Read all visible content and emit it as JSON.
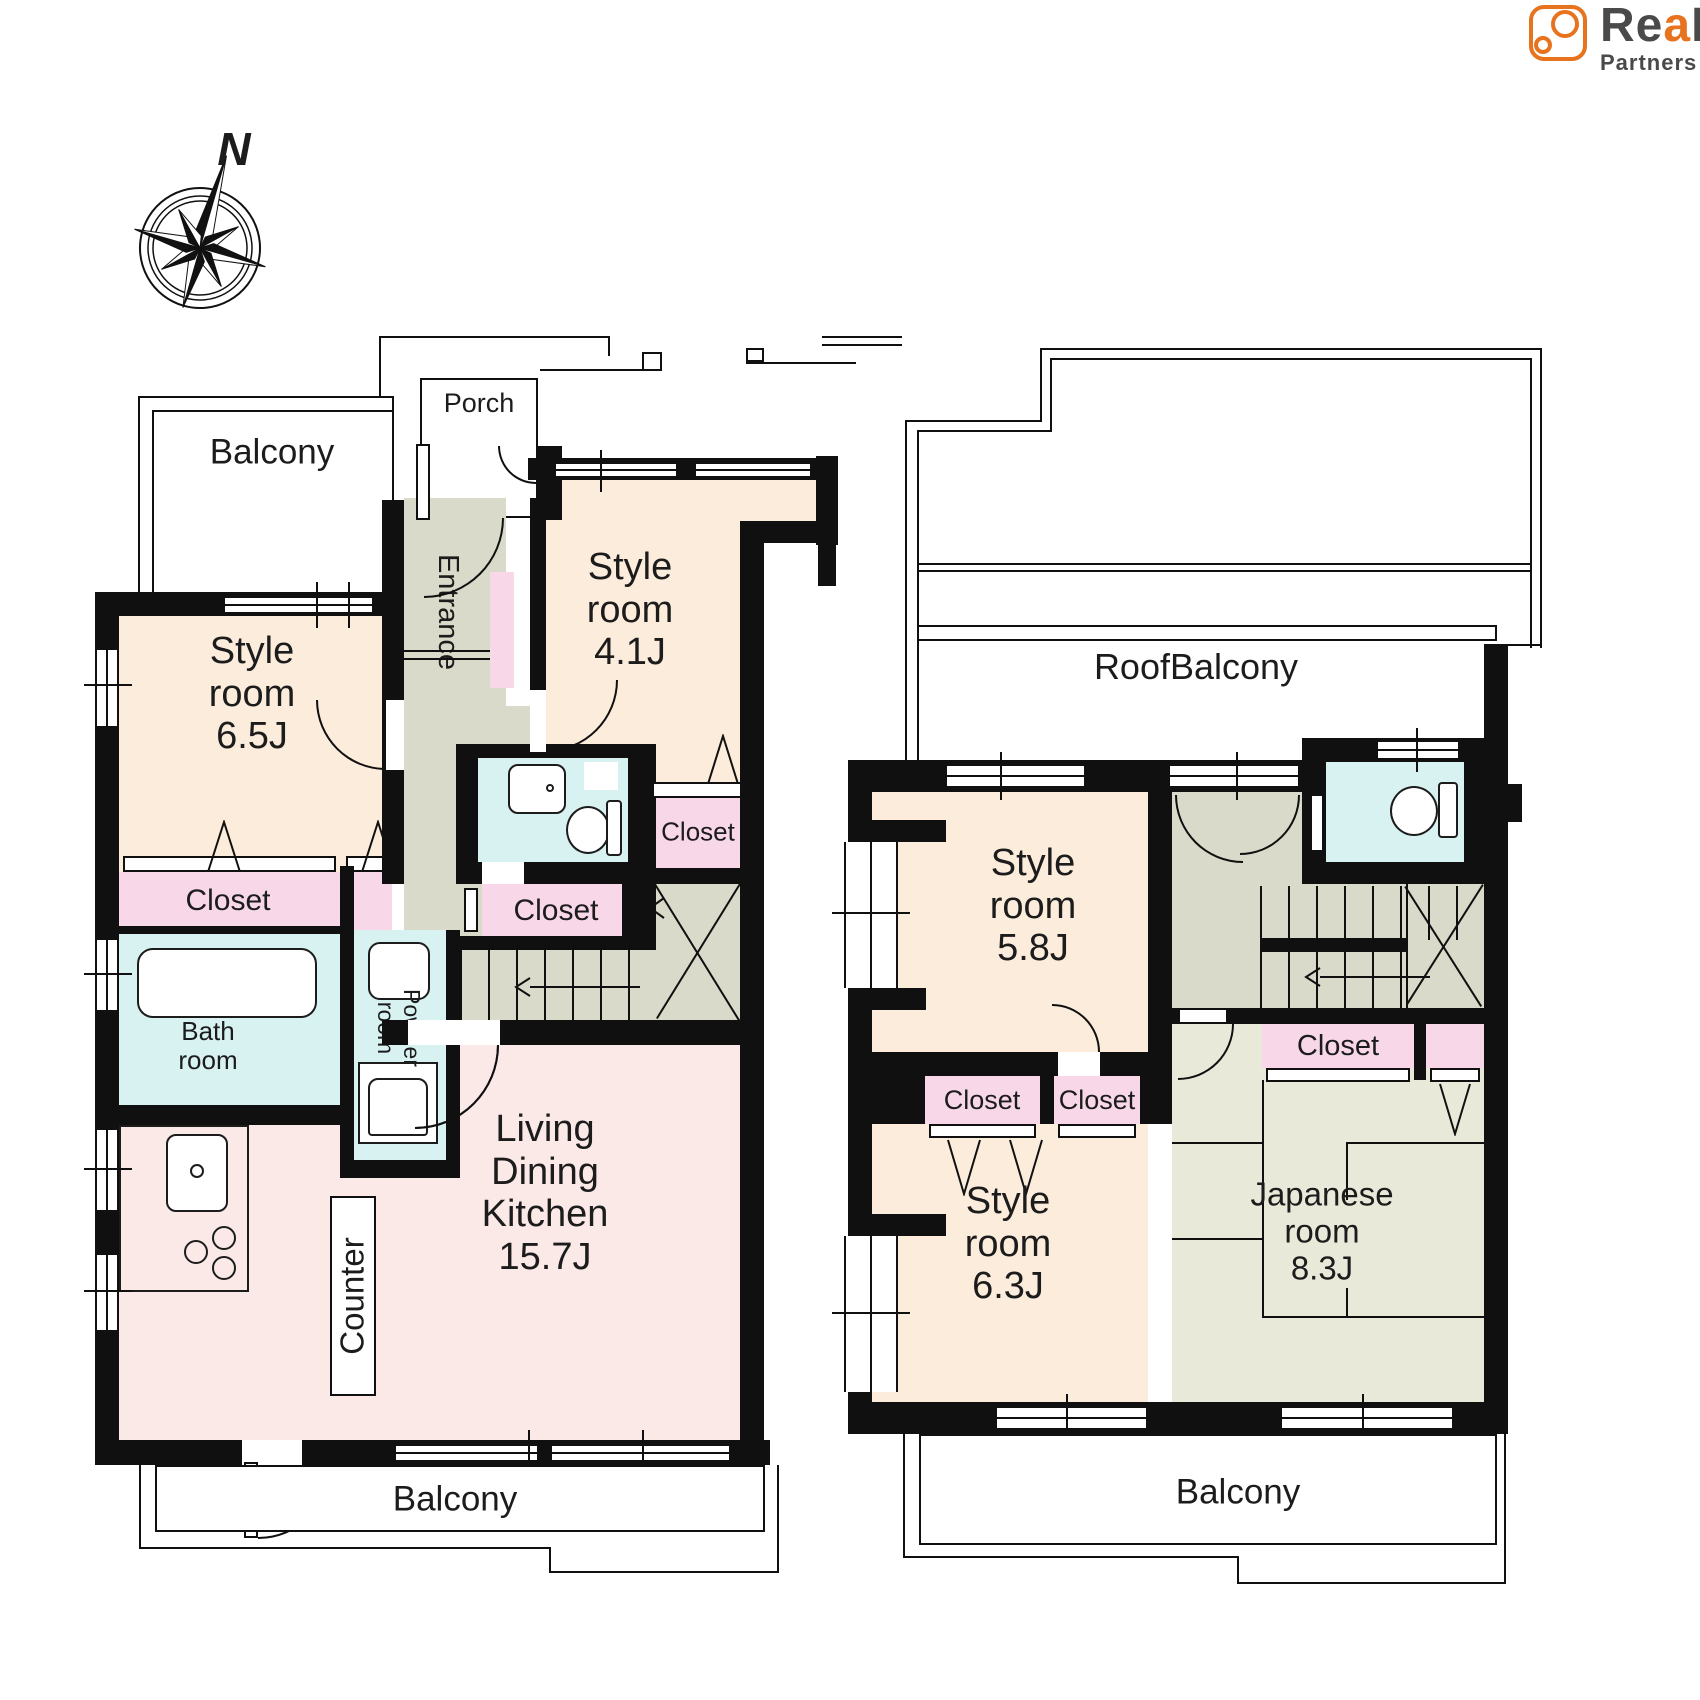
{
  "logo": {
    "brand_prefix": "Re",
    "brand_accent_letter": "a",
    "brand_suffix": "L",
    "subtitle": "Partners",
    "accent_color": "#e8731e",
    "text_color": "#4a4a4a"
  },
  "compass": {
    "north_label": "N"
  },
  "colors": {
    "wall": "#101010",
    "room_peach": "#fcecdb",
    "ldk_pink": "#fbe9e8",
    "closet_pink": "#f8d7e8",
    "wet_cyan": "#d8f1f1",
    "hall_gray": "#d9dac9",
    "tatami_green": "#e9e9da"
  },
  "floor1": {
    "balcony_top_label": "Balcony",
    "porch_label": "Porch",
    "entrance_label": "Entrance",
    "style_room_65": [
      "Style",
      "room",
      "6.5J"
    ],
    "style_room_41": [
      "Style",
      "room",
      "4.1J"
    ],
    "closet_main_label": "Closet",
    "closet_hall_label": "Closet",
    "closet_41_label": "Closet",
    "bath_room": [
      "Bath",
      "room"
    ],
    "powder_room": [
      "Powder",
      "room"
    ],
    "ldk": [
      "Living",
      "Dining",
      "Kitchen",
      "15.7J"
    ],
    "counter_label": "Counter",
    "balcony_bottom_label": "Balcony"
  },
  "floor2": {
    "roof_balcony_label": "RoofBalcony",
    "style_room_58": [
      "Style",
      "room",
      "5.8J"
    ],
    "style_room_63": [
      "Style",
      "room",
      "6.3J"
    ],
    "japanese_room": [
      "Japanese",
      "room",
      "8.3J"
    ],
    "closet_a_label": "Closet",
    "closet_b_label": "Closet",
    "closet_c_label": "Closet",
    "balcony_label": "Balcony"
  }
}
